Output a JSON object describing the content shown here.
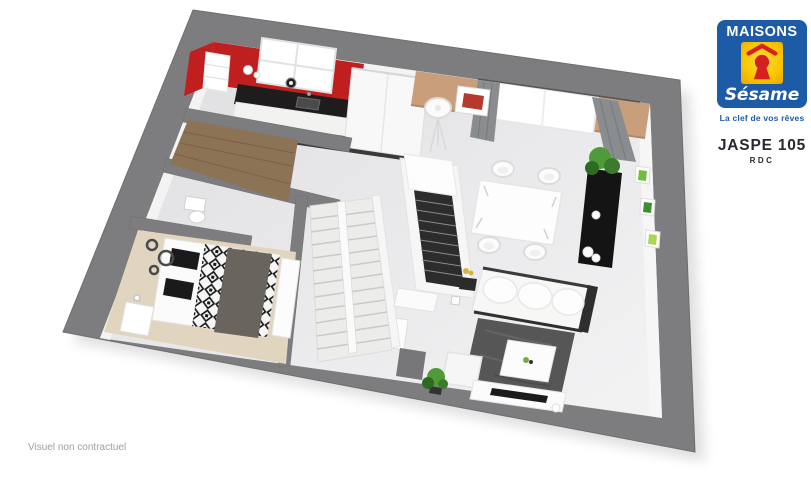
{
  "brand": {
    "name": "MAISONS",
    "logo_word": "Sésame",
    "tagline": "La clef de vos rêves",
    "colors": {
      "blue": "#1d5ba6",
      "yellow": "#f8c900",
      "red": "#d6201f",
      "text_dark": "#2a2731"
    }
  },
  "plan_header": {
    "model_name": "JASPE 105",
    "floor_label": "RDC"
  },
  "footer": {
    "disclaimer": "Visuel non contractuel"
  },
  "floor_plan": {
    "view": "3d-isometric-render-ground-floor",
    "rooms": [
      {
        "name": "kitchen"
      },
      {
        "name": "entry-hall"
      },
      {
        "name": "wc"
      },
      {
        "name": "bedroom"
      },
      {
        "name": "staircase"
      },
      {
        "name": "closet"
      },
      {
        "name": "dining-area"
      },
      {
        "name": "living-room"
      }
    ],
    "colors": {
      "wall_gray": "#7d7d7f",
      "floor_light": "#eaeaec",
      "kitchen_red": "#c01f1f",
      "counter_black": "#1e1c1c",
      "dining_beige": "#c89e7b",
      "carpet_beige": "#e2d5c0",
      "wood_brown": "#8d7355",
      "rug_gray": "#565656",
      "curtain_gray": "#8a8d90",
      "plant_green": "#4f9b39"
    }
  }
}
